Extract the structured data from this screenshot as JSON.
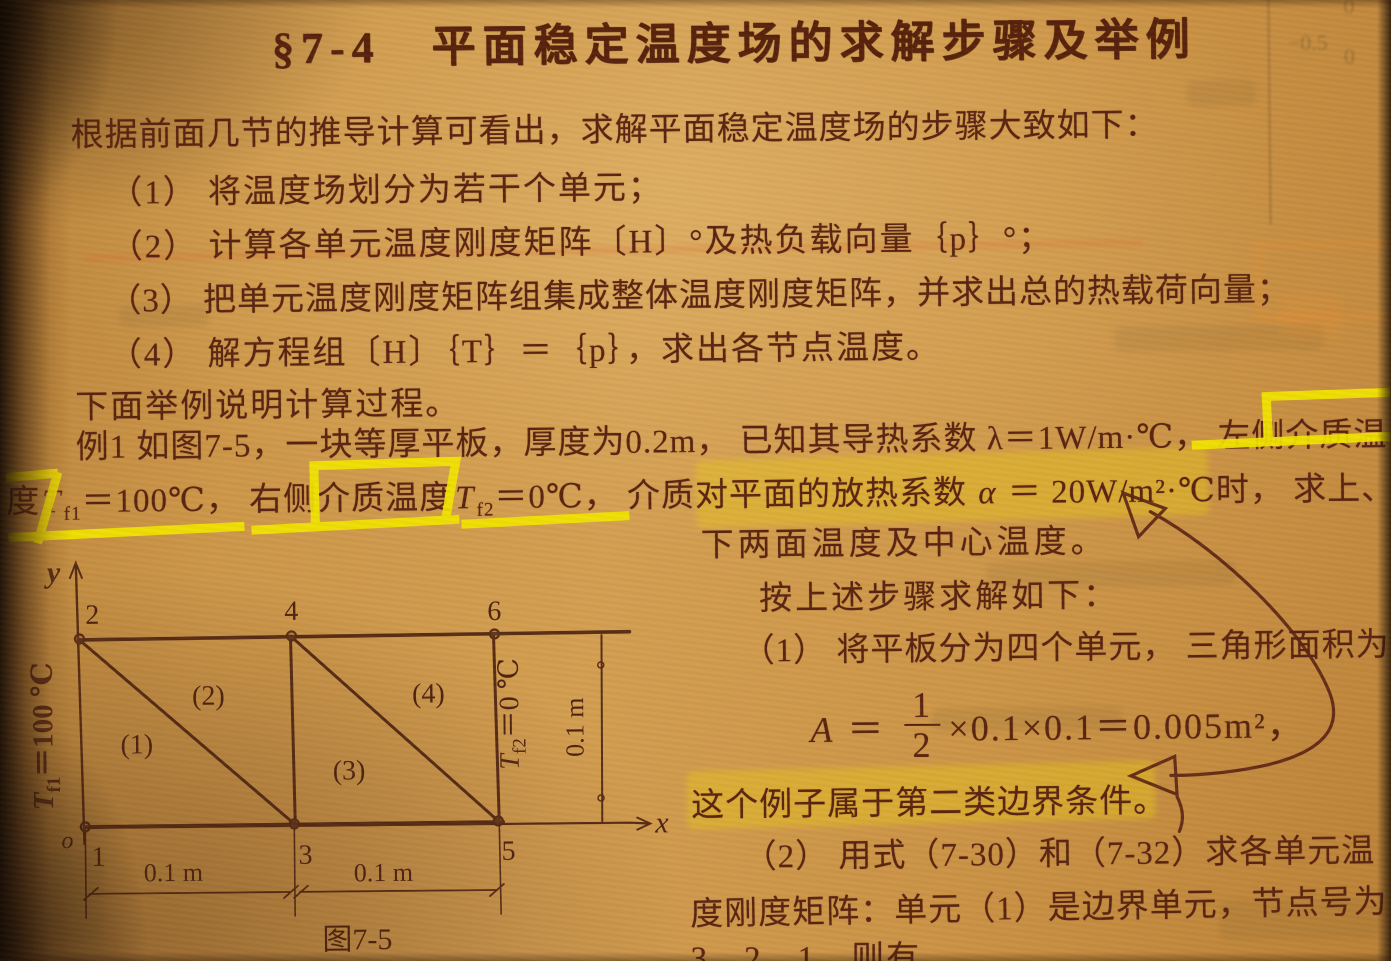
{
  "colors": {
    "paper": "#cd9749",
    "ink": "#5a2511",
    "marker_yellow": "#f1e300",
    "highlight": "#e9c819",
    "handwriting": "#5c2414"
  },
  "doc": {
    "title": "§7-4　平面稳定温度场的求解步骤及举例",
    "intro": "根据前面几节的推导计算可看出，求解平面稳定温度场的步骤大致如下：",
    "steps": [
      "（1） 将温度场划分为若干个单元；",
      "（2） 计算各单元温度刚度矩阵〔H〕°及热负载向量｛p｝°；",
      "（3） 把单元温度刚度矩阵组集成整体温度刚度矩阵，并求出总的热载荷向量；",
      "（4） 解方程组〔H〕｛T｝＝｛p｝，求出各节点温度。"
    ],
    "lead_in": "下面举例说明计算过程。",
    "example": {
      "line1": "例1 如图7-5，一块等厚平板，厚度为0.2m， 已知其导热系数 λ＝1W/m·℃， 左侧介质温",
      "line2": {
        "p1": "度",
        "v1": "T",
        "s1": "f1",
        "p2": "＝100℃， 右侧介质温度",
        "v2": "T",
        "s2": "f2",
        "p3": "＝0℃， 介质对平面的放热系数 ",
        "v3": "α",
        "p4": " ＝ 20W/m²·℃时， 求上、"
      }
    }
  },
  "right": {
    "cont": "下两面温度及中心温度。",
    "solve_intro": "按上述步骤求解如下：",
    "step1": "（1） 将平板分为四个单元， 三角形面积为",
    "formula": {
      "v": "A",
      "eq": " ＝ ",
      "num": "1",
      "den": "2",
      "post": "×0.1×0.1＝0.005m²，"
    },
    "note": "这个例子属于第二类边界条件。",
    "s2l1": "（2） 用式（7-30）和（7-32）求各单元温",
    "s2l2": "度刚度矩阵：单元（1）是边界单元，节点号为",
    "s2l3": "3、2、1，则有"
  },
  "figure": {
    "y_label": "y",
    "x_label": "x",
    "origin": "o",
    "node_top": [
      "2",
      "4",
      "6"
    ],
    "node_bottom": [
      "1",
      "3",
      "5"
    ],
    "elements": [
      "(1)",
      "(2)",
      "(3)",
      "(4)"
    ],
    "left_label": {
      "v": "T",
      "s": "f1",
      "rest": "＝100 ℃"
    },
    "right_label": {
      "v": "T",
      "s": "f2",
      "rest": "＝0 ℃"
    },
    "dim_right": "0.1 m",
    "dims": [
      "0.1 m",
      "0.1 m"
    ],
    "caption": "图7-5"
  },
  "bleed_marks": [
    "0",
    "−0.5",
    "0"
  ]
}
